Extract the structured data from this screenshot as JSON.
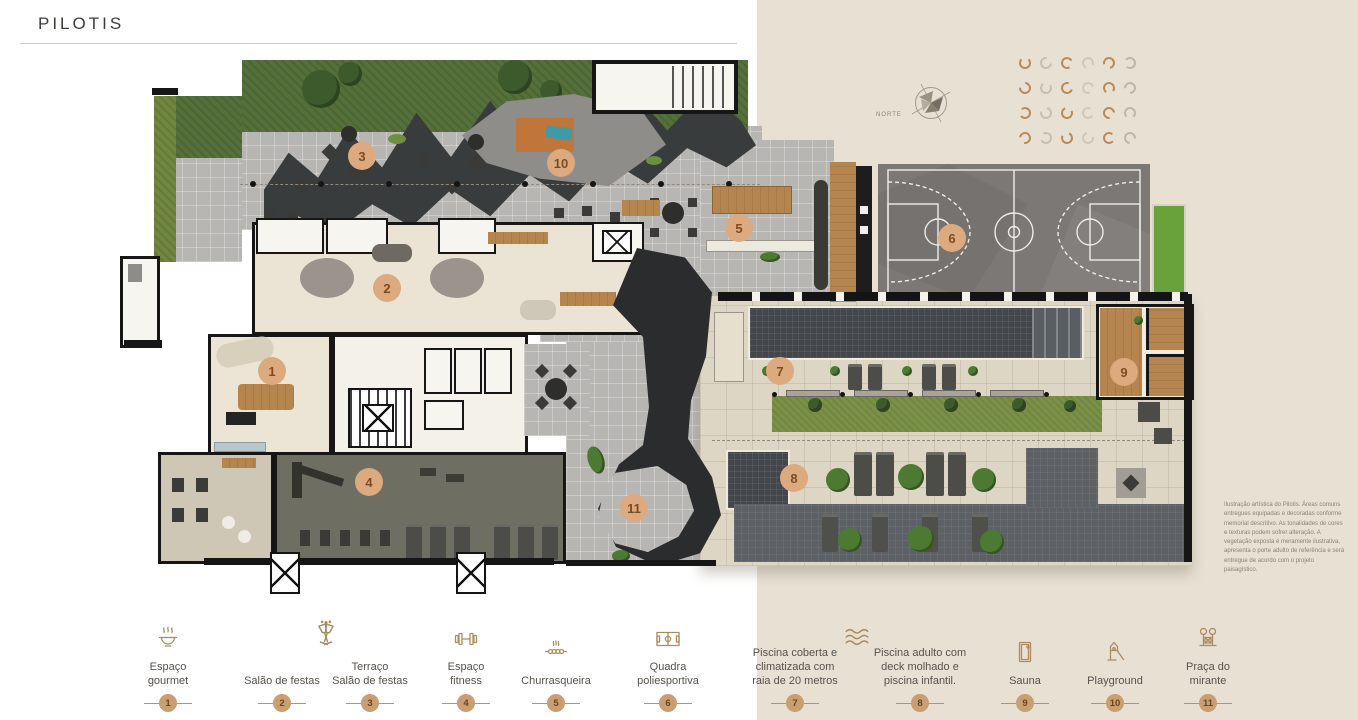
{
  "page": {
    "title": "PILOTIS"
  },
  "compass": {
    "label": "NORTE"
  },
  "disclaimer": {
    "text": "Ilustração artística do Pilotis. Áreas comuns entregues equipadas e decoradas conforme memorial descritivo. As tonalidades de cores e texturas podem sofrer alteração. A vegetação exposta é meramente ilustrativa, apresenta o porte adulto de referência e será entregue de acordo com o projeto paisagístico."
  },
  "colors": {
    "accent_bronze": "#ad8b60",
    "panel_beige": "#e8e0d3",
    "badge_fill": "#c89e73",
    "marker_fill": "#dcaa7e"
  },
  "legend": {
    "items": [
      {
        "num": "1",
        "label": "Espaço\ngourmet"
      },
      {
        "num": "2",
        "label": "Salão de festas"
      },
      {
        "num": "3",
        "label": "Terraço\nSalão de festas"
      },
      {
        "num": "4",
        "label": "Espaço\nfitness"
      },
      {
        "num": "5",
        "label": "Churrasqueira"
      },
      {
        "num": "6",
        "label": "Quadra\npoliesportiva"
      },
      {
        "num": "7",
        "label": "Piscina coberta e\nclimatizada com\nraia de 20 metros"
      },
      {
        "num": "8",
        "label": "Piscina adulto com\ndeck molhado e\npiscina infantil."
      },
      {
        "num": "9",
        "label": "Sauna"
      },
      {
        "num": "10",
        "label": "Playground"
      },
      {
        "num": "11",
        "label": "Praça do\nmirante"
      }
    ]
  },
  "plan": {
    "markers": [
      {
        "num": "1",
        "x": 272,
        "y": 371
      },
      {
        "num": "2",
        "x": 387,
        "y": 288
      },
      {
        "num": "3",
        "x": 362,
        "y": 156
      },
      {
        "num": "4",
        "x": 369,
        "y": 482
      },
      {
        "num": "5",
        "x": 739,
        "y": 228
      },
      {
        "num": "6",
        "x": 952,
        "y": 238
      },
      {
        "num": "7",
        "x": 780,
        "y": 371
      },
      {
        "num": "8",
        "x": 794,
        "y": 478
      },
      {
        "num": "9",
        "x": 1124,
        "y": 372
      },
      {
        "num": "10",
        "x": 561,
        "y": 163
      },
      {
        "num": "11",
        "x": 634,
        "y": 508
      }
    ]
  },
  "deco": {
    "rows": 4,
    "cols": 6,
    "colors": [
      "#b98a58",
      "#c7bfae",
      "#b98a58",
      "#cfc8b8",
      "#b98a58",
      "#c0b6a4"
    ]
  }
}
